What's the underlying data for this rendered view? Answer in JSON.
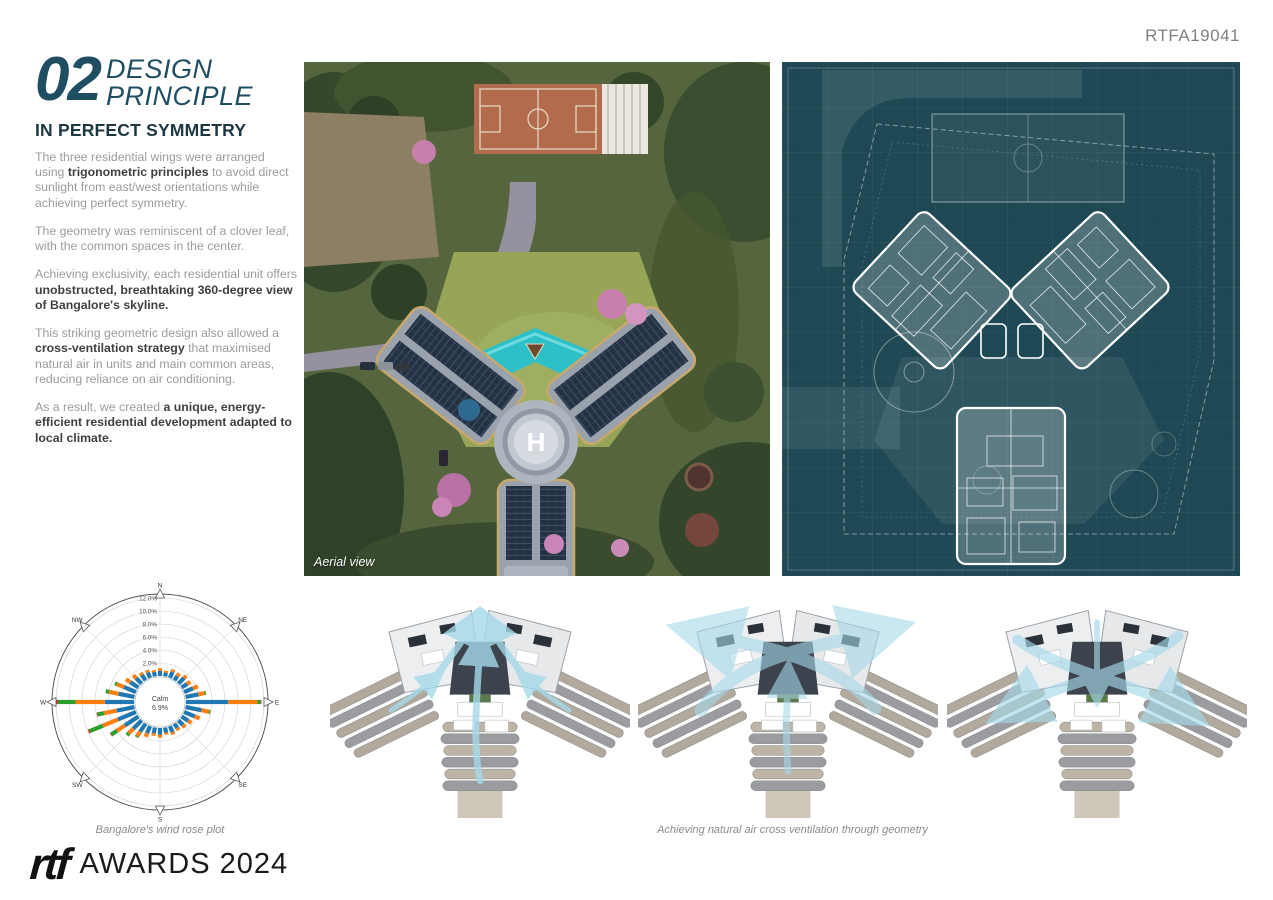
{
  "code": "RTFA19041",
  "heading": {
    "number": "02",
    "title_line1": "DESIGN",
    "title_line2": "PRINCIPLE",
    "subtitle": "IN PERFECT SYMMETRY"
  },
  "article": {
    "paragraphs": [
      [
        [
          "The three residential wings were arranged using ",
          0
        ],
        [
          "trigonometric principles",
          1
        ],
        [
          " to avoid direct sunlight from east/west orientations while achieving perfect symmetry.",
          0
        ]
      ],
      [
        [
          "The geometry was reminiscent of a clover leaf, with the common spaces in the center.",
          0
        ]
      ],
      [
        [
          "Achieving exclusivity, each residential unit offers ",
          0
        ],
        [
          "unobstructed, breathtaking 360-degree view of Bangalore's skyline.",
          1
        ]
      ],
      [
        [
          "This striking geometric design also allowed a ",
          0
        ],
        [
          "cross-ventilation strategy",
          1
        ],
        [
          " that maximised natural air in units and main common areas, reducing reliance on air conditioning.",
          0
        ]
      ],
      [
        [
          "As a result, we created ",
          0
        ],
        [
          "a unique, energy-efficient residential development adapted to local climate.",
          1
        ]
      ]
    ]
  },
  "captions": {
    "aerial": "Aerial view",
    "wind_rose": "Bangalore's wind rose plot",
    "ventilation": "Achieving natural air cross ventilation through geometry"
  },
  "footer": {
    "logo": "rtf",
    "awards": "AWARDS 2024"
  },
  "colors": {
    "accent_teal": "#1f4e63",
    "subtitle_dark": "#1c3642",
    "body_gray": "#9b9b9b",
    "body_bold": "#3f3f3f",
    "blueprint_bg": "#1e4853",
    "airflow_blue": "#a6d9ea"
  },
  "chart_data": {
    "type": "wind_rose",
    "title": "Bangalore's wind rose plot",
    "units": "%",
    "calm_label": "Calm",
    "calm_value": "6.9%",
    "ring_ticks": [
      "2.0%",
      "4.0%",
      "6.0%",
      "8.0%",
      "10.0%",
      "12.0%"
    ],
    "ring_values": [
      2,
      4,
      6,
      8,
      10,
      12
    ],
    "max_ring": 12,
    "compass": [
      "N",
      "NE",
      "E",
      "SE",
      "S",
      "SW",
      "W",
      "NW"
    ],
    "speed_bin_colors": [
      "#1f77b4",
      "#ff7f0e",
      "#2ca02c",
      "#d62728"
    ],
    "directions_count": 32,
    "frequencies": [
      [
        0.8,
        0.4,
        0,
        0
      ],
      [
        0.6,
        0.3,
        0,
        0
      ],
      [
        1.0,
        0.4,
        0,
        0
      ],
      [
        0.8,
        0.5,
        0,
        0
      ],
      [
        1.2,
        0.5,
        0,
        0
      ],
      [
        1.0,
        0.6,
        0,
        0
      ],
      [
        1.5,
        0.8,
        0,
        0
      ],
      [
        2.0,
        1.0,
        0.2,
        0
      ],
      [
        6.5,
        4.5,
        0.5,
        0.1
      ],
      [
        2.5,
        1.2,
        0.2,
        0
      ],
      [
        1.8,
        0.8,
        0,
        0
      ],
      [
        1.2,
        0.6,
        0,
        0
      ],
      [
        1.0,
        0.5,
        0,
        0
      ],
      [
        0.8,
        0.4,
        0,
        0
      ],
      [
        1.0,
        0.4,
        0,
        0
      ],
      [
        0.8,
        0.3,
        0,
        0
      ],
      [
        1.0,
        0.5,
        0,
        0
      ],
      [
        0.9,
        0.4,
        0,
        0
      ],
      [
        1.2,
        0.6,
        0,
        0
      ],
      [
        1.5,
        0.8,
        0.2,
        0
      ],
      [
        1.8,
        1.0,
        0.4,
        0
      ],
      [
        2.5,
        1.5,
        1.0,
        0.1
      ],
      [
        3.0,
        2.5,
        2.2,
        0.2
      ],
      [
        2.8,
        2.0,
        1.0,
        0.1
      ],
      [
        4.5,
        4.5,
        2.7,
        0.3
      ],
      [
        2.5,
        1.5,
        0.5,
        0
      ],
      [
        2.0,
        1.2,
        0.3,
        0
      ],
      [
        1.5,
        0.8,
        0,
        0
      ],
      [
        1.2,
        0.6,
        0,
        0
      ],
      [
        1.0,
        0.4,
        0,
        0
      ],
      [
        0.9,
        0.4,
        0,
        0
      ],
      [
        0.7,
        0.3,
        0,
        0
      ]
    ]
  }
}
